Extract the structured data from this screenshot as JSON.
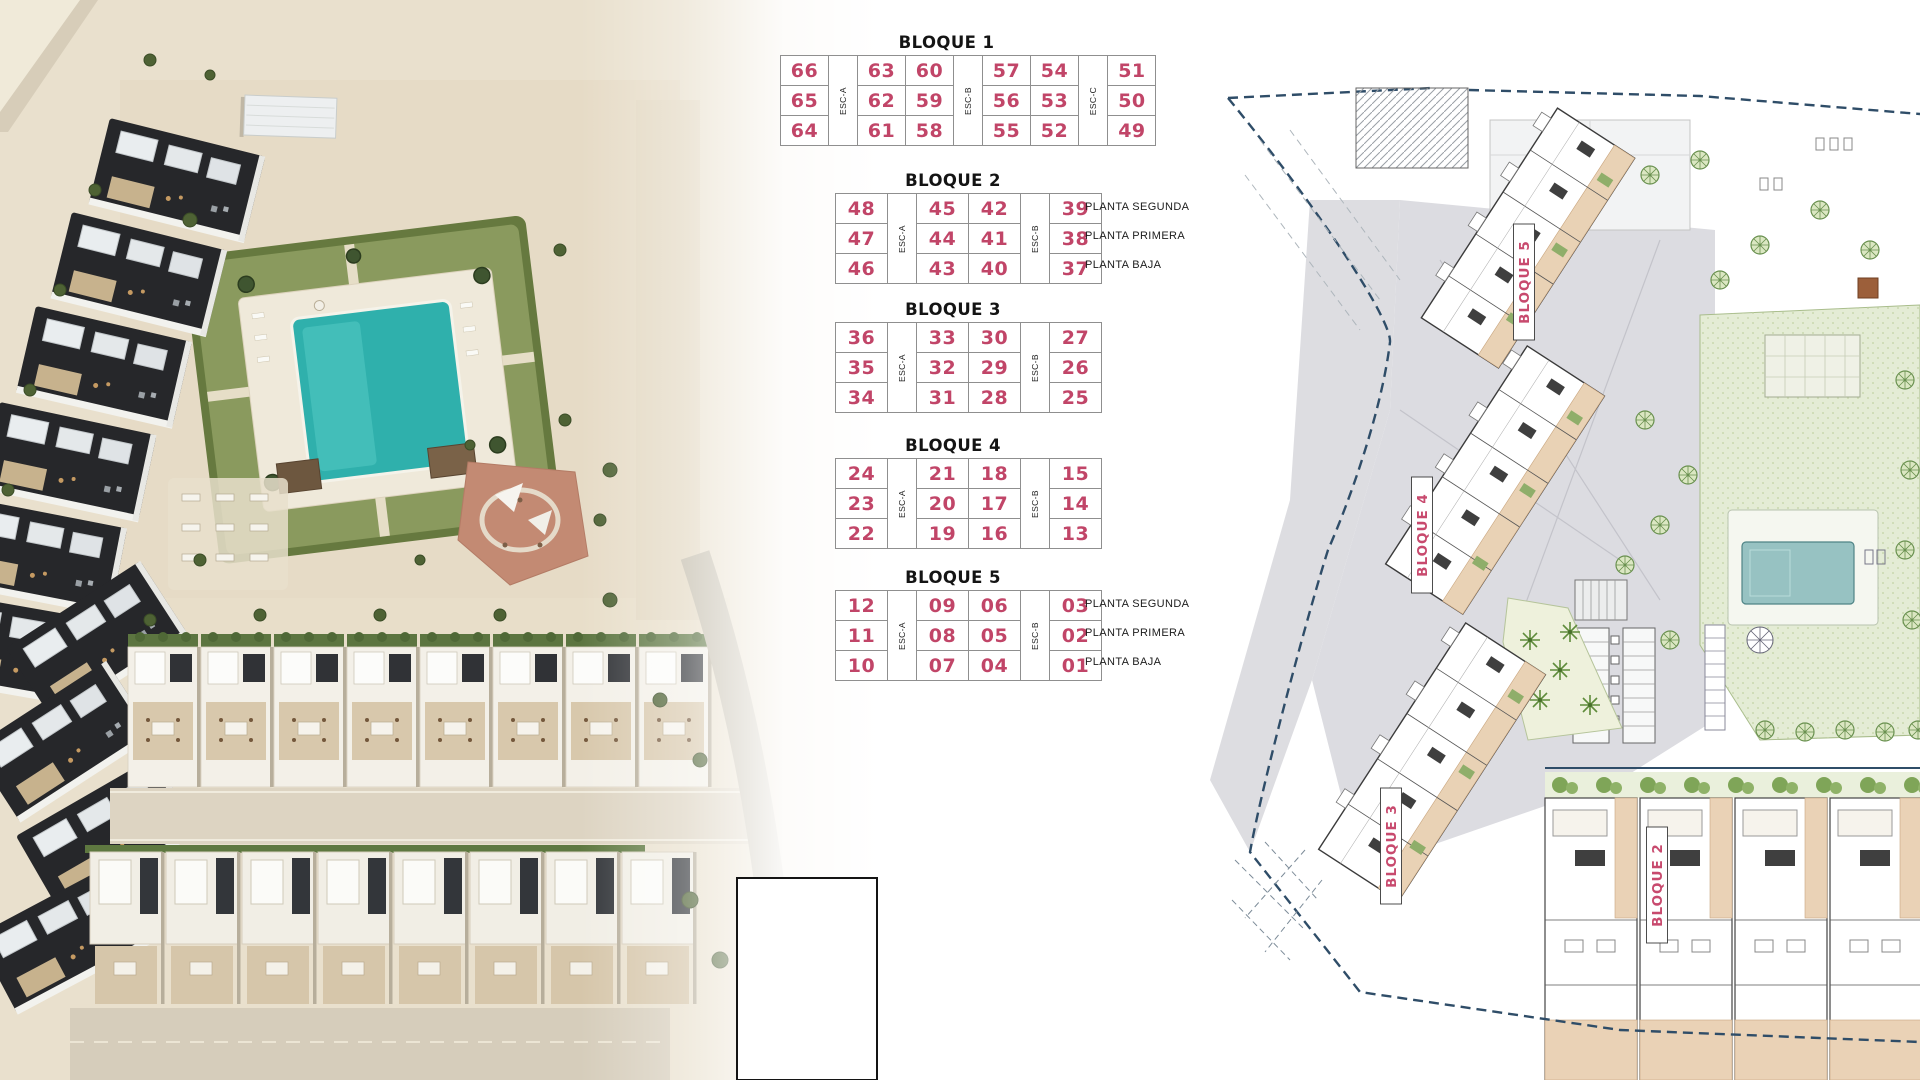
{
  "colors": {
    "unit_number": "#c14568",
    "block_label": "#c84a6e",
    "table_border": "#8f8f8f",
    "plan_boundary": "#2f4d68",
    "pool": "#2fb0ac"
  },
  "blocks": [
    {
      "title": "BLOQUE 1",
      "esc": [
        "ESC-A",
        "ESC-B",
        "ESC-C"
      ],
      "rows": [
        [
          "66",
          "63",
          "60",
          "57",
          "54",
          "51"
        ],
        [
          "65",
          "62",
          "59",
          "56",
          "53",
          "50"
        ],
        [
          "64",
          "61",
          "58",
          "55",
          "52",
          "49"
        ]
      ],
      "planta": []
    },
    {
      "title": "BLOQUE 2",
      "esc": [
        "ESC-A",
        "ESC-B"
      ],
      "rows": [
        [
          "48",
          "45",
          "42",
          "39"
        ],
        [
          "47",
          "44",
          "41",
          "38"
        ],
        [
          "46",
          "43",
          "40",
          "37"
        ]
      ],
      "planta": [
        "PLANTA SEGUNDA",
        "PLANTA PRIMERA",
        "PLANTA BAJA"
      ]
    },
    {
      "title": "BLOQUE 3",
      "esc": [
        "ESC-A",
        "ESC-B"
      ],
      "rows": [
        [
          "36",
          "33",
          "30",
          "27"
        ],
        [
          "35",
          "32",
          "29",
          "26"
        ],
        [
          "34",
          "31",
          "28",
          "25"
        ]
      ],
      "planta": []
    },
    {
      "title": "BLOQUE 4",
      "esc": [
        "ESC-A",
        "ESC-B"
      ],
      "rows": [
        [
          "24",
          "21",
          "18",
          "15"
        ],
        [
          "23",
          "20",
          "17",
          "14"
        ],
        [
          "22",
          "19",
          "16",
          "13"
        ]
      ],
      "planta": []
    },
    {
      "title": "BLOQUE 5",
      "esc": [
        "ESC-A",
        "ESC-B"
      ],
      "rows": [
        [
          "12",
          "09",
          "06",
          "03"
        ],
        [
          "11",
          "08",
          "05",
          "02"
        ],
        [
          "10",
          "07",
          "04",
          "01"
        ]
      ],
      "planta": [
        "PLANTA SEGUNDA",
        "PLANTA PRIMERA",
        "PLANTA BAJA"
      ]
    }
  ],
  "site_plan": {
    "labels": [
      {
        "id": "bloque-5",
        "text": "BLOQUE 5"
      },
      {
        "id": "bloque-4",
        "text": "BLOQUE 4"
      },
      {
        "id": "bloque-3",
        "text": "BLOQUE 3"
      },
      {
        "id": "bloque-2",
        "text": "BLOQUE 2"
      }
    ]
  }
}
